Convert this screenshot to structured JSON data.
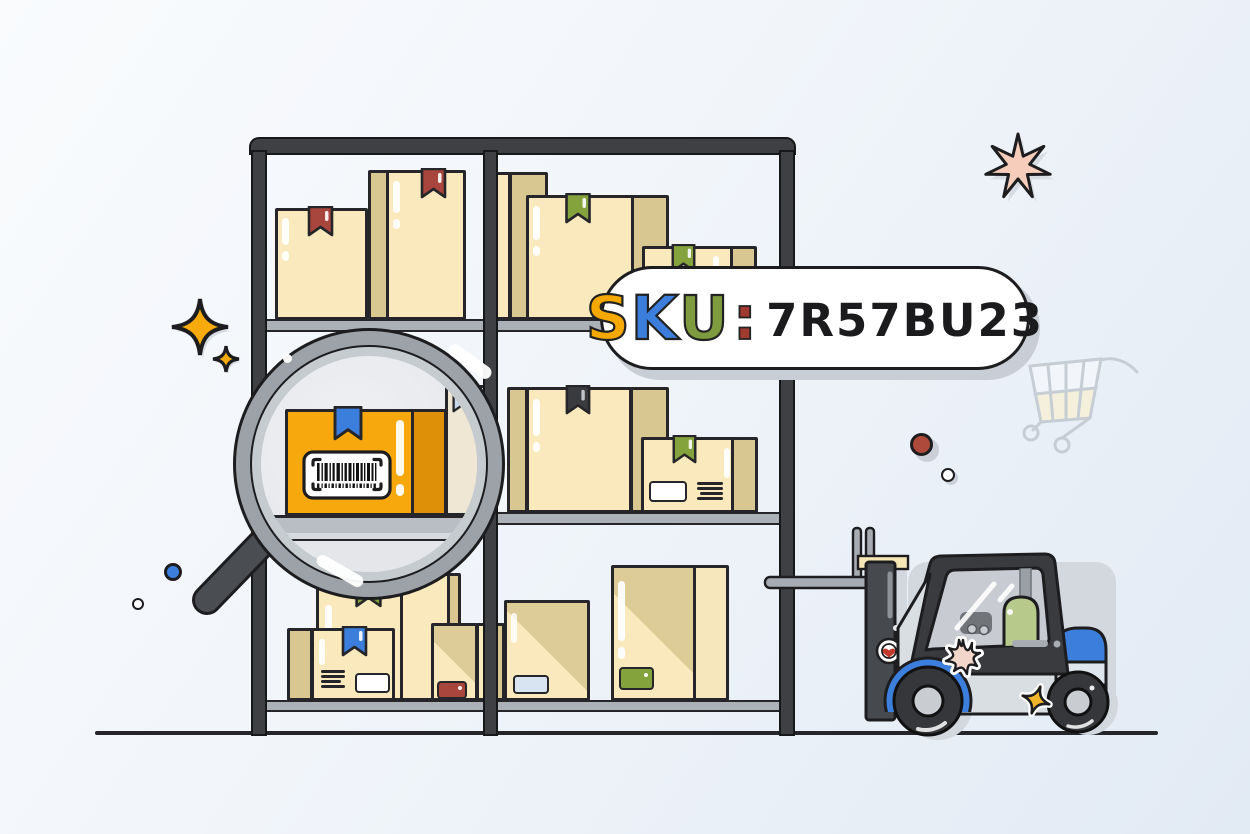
{
  "bubble": {
    "sku_label": {
      "s": "S",
      "k": "K",
      "u": "U",
      "colon": ":"
    },
    "code": "7R57BU23",
    "colors": {
      "s": "#F5A800",
      "k": "#3C7EDB",
      "u": "#7E9C3F",
      "colon": "#A03B30",
      "code": "#1B1B1D",
      "bubble_bg": "#FFFFFF",
      "bubble_border": "#1D1D1F"
    }
  },
  "illustration": {
    "description": "Warehouse shelving rack filled with cardboard boxes; a magnifying glass highlights an orange box with a barcode; a forklift stands to the right",
    "icons": [
      "magnifying-glass-icon",
      "barcode-icon",
      "forklift-icon",
      "shopping-cart-icon",
      "sparkle-icon",
      "burst-star-icon",
      "ribbon-icon",
      "heart-sticker-icon",
      "splat-sticker-icon",
      "star-sticker-icon"
    ],
    "colors": {
      "background_start": "#F9FBFD",
      "background_end": "#E2EAF4",
      "rack": "#3E4043",
      "shelf_board": "#ACB1B8",
      "outline": "#26262A",
      "box_front": "#FAE9BC",
      "box_side": "#D9C792",
      "box_diag_shade": "#DECC98",
      "ribbon_red": "#A8453C",
      "ribbon_green": "#84A33D",
      "ribbon_blue": "#3C7EDB",
      "ribbon_dark": "#3A3B3E",
      "ribbon_pale": "#C9D7EC",
      "highlight_box": "#F7A80D",
      "highlight_box_side": "#DE9009",
      "label_red": "#A8453C",
      "label_green": "#84A33D",
      "label_blue": "#D8E4F2",
      "forklift_body": "#D9DEE3",
      "forklift_cab": "#3A3B3E",
      "forklift_blue": "#3C7EDB",
      "forklift_mast": "#46494E",
      "fork_gray": "#A7ACB2",
      "crossbar_cream": "#F7E6B5",
      "seat_green": "#B7C98B",
      "window_gray": "#C8CCD2",
      "sparkle_yellow": "#F6AB0A",
      "burst_pink": "#F5CDBA",
      "dot_blue": "#3C7EDB",
      "dot_red": "#AE4A3B",
      "magnifier_rim": "#9DA2A8",
      "magnifier_rim_inner": "#C6CBD0",
      "magnifier_handle": "#4A4E53",
      "cart_stroke": "#C7CDD5",
      "ground": "#26262A"
    }
  }
}
